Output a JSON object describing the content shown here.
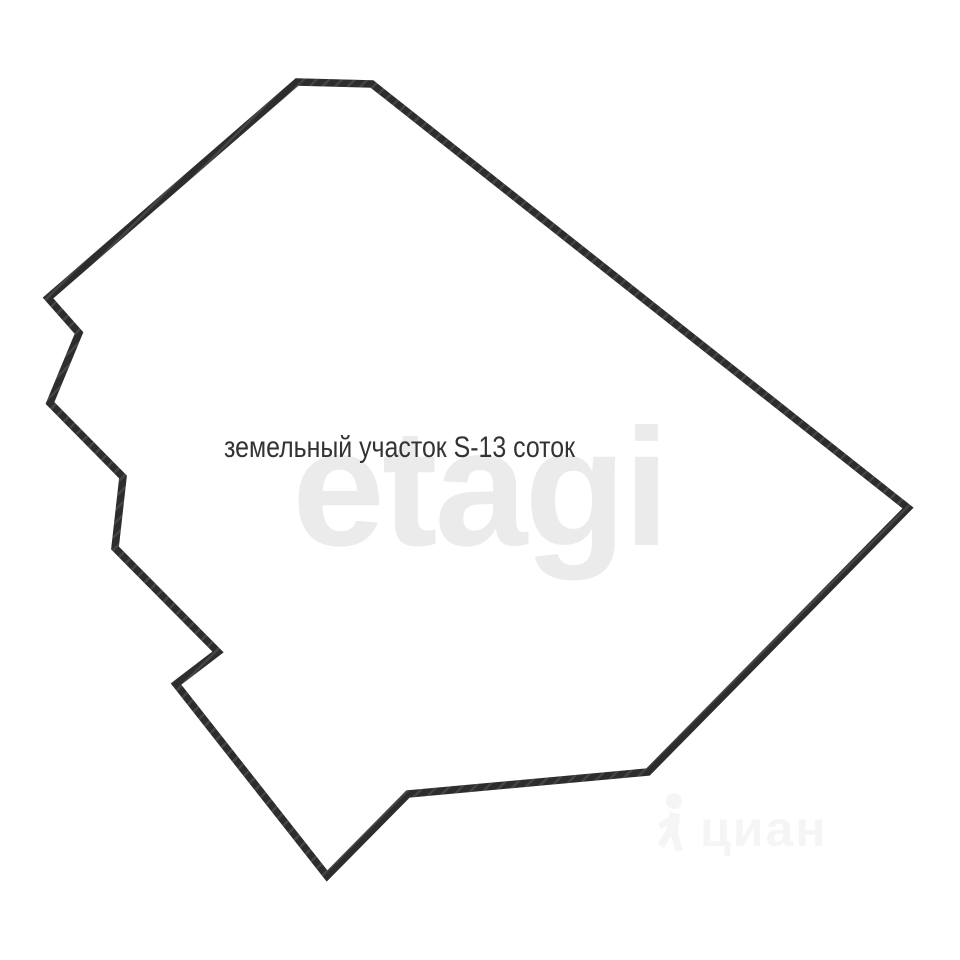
{
  "page": {
    "background_color": "#ffffff"
  },
  "plot": {
    "label": "земельный участок S-13 соток",
    "label_color": "#333333",
    "outline_color": "#2d2d2d",
    "outline_width": "7.5",
    "polygon_points": "297,82 372,84 908,508 648,772 408,794 327,876 176,684 218,652 115,548 123,477 50,403 79,333 48,298"
  },
  "watermarks": {
    "etagi": {
      "text": "etagi",
      "color": "#ebebeb"
    },
    "cian": {
      "text": "циан",
      "color": "#f5f5f5"
    }
  }
}
